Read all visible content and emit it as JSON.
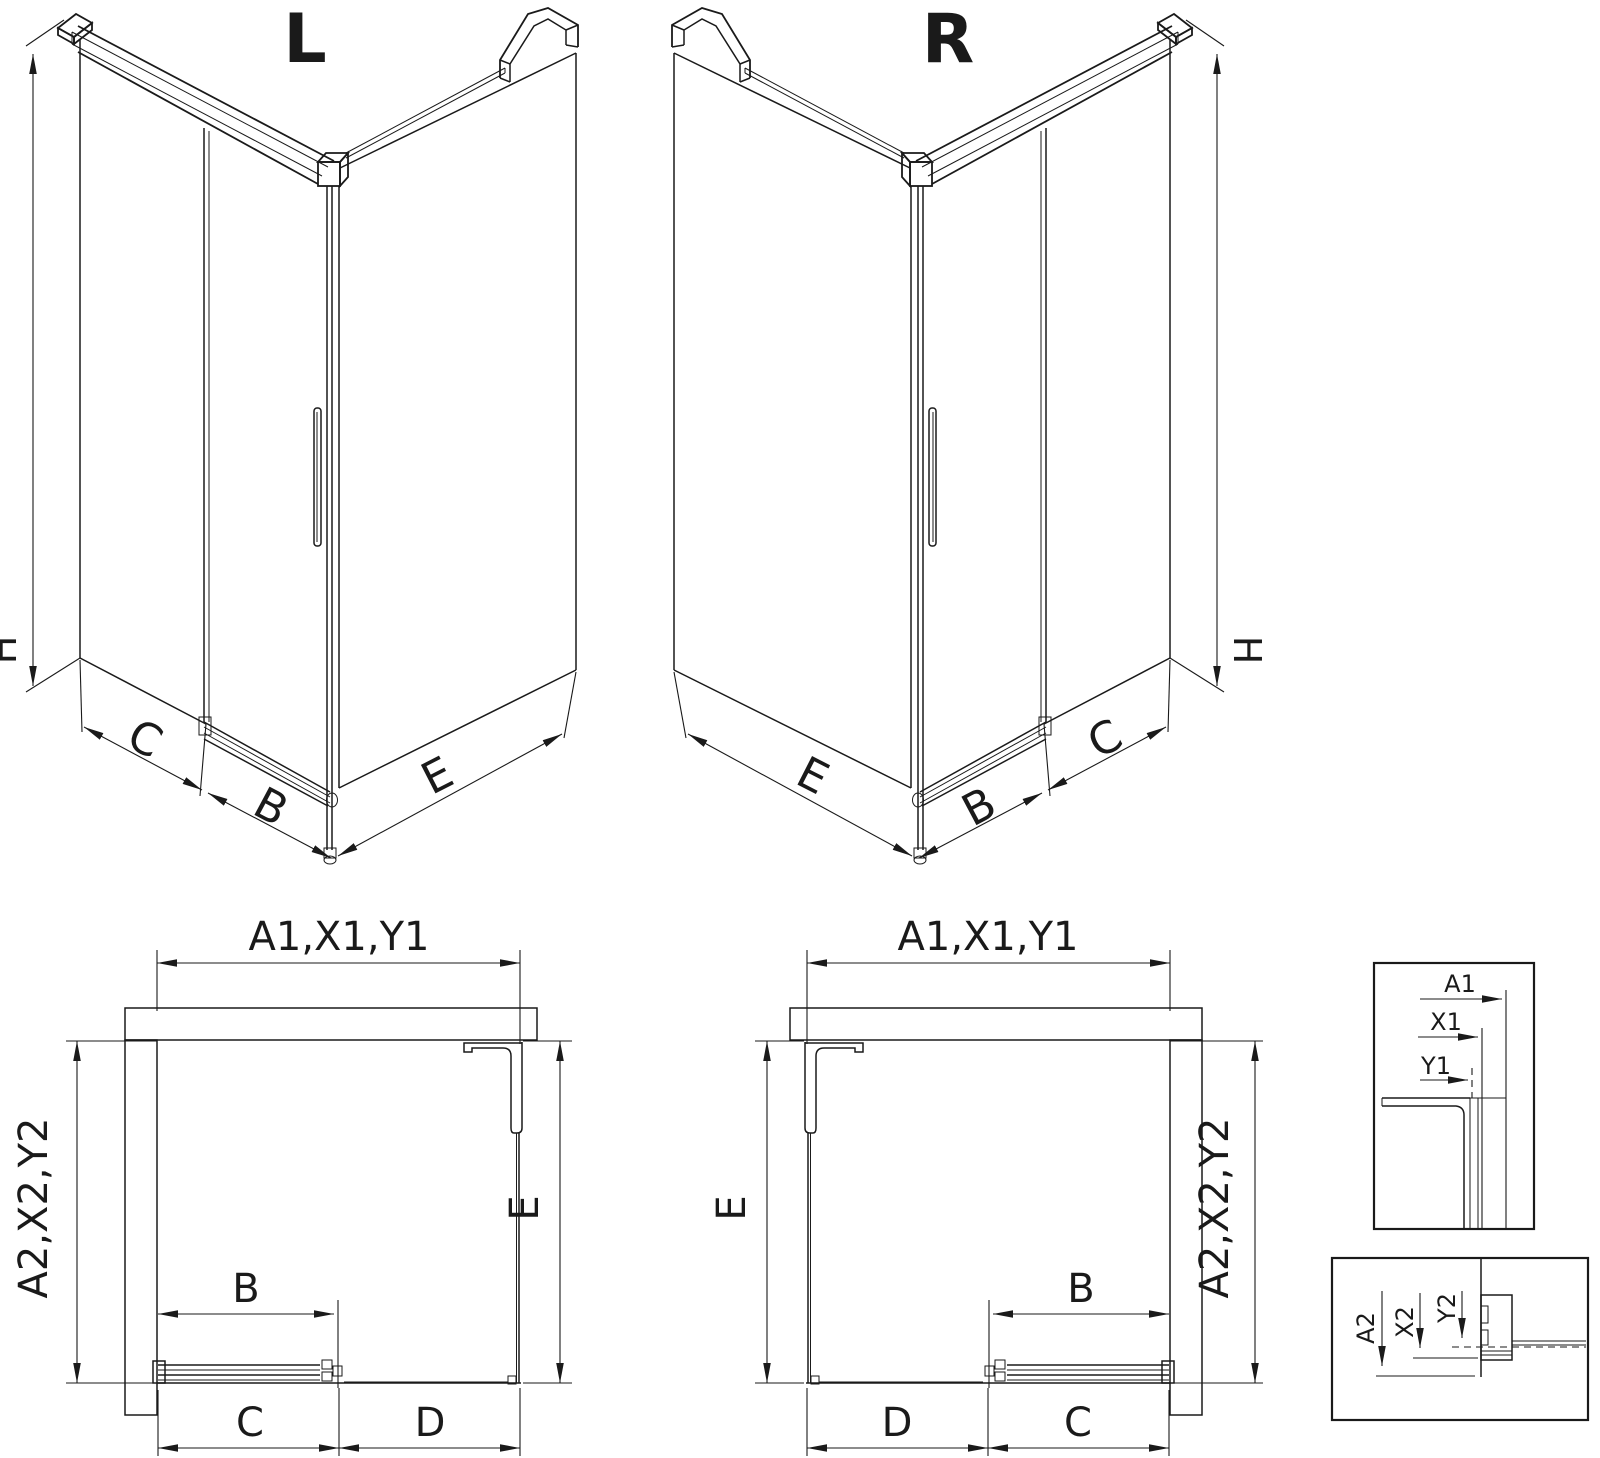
{
  "colors": {
    "line": "#1a1a1a",
    "background": "#ffffff"
  },
  "views": {
    "iso_left": {
      "title": "L",
      "dim_height": "H",
      "dim_c": "C",
      "dim_b": "B",
      "dim_e": "E"
    },
    "iso_right": {
      "title": "R",
      "dim_height": "H",
      "dim_c": "C",
      "dim_b": "B",
      "dim_e": "E"
    },
    "plan_left": {
      "dim_width": "A1,X1,Y1",
      "dim_depth": "A2,X2,Y2",
      "dim_b": "B",
      "dim_c": "C",
      "dim_d": "D",
      "dim_e": "E"
    },
    "plan_right": {
      "dim_width": "A1,X1,Y1",
      "dim_depth": "A2,X2,Y2",
      "dim_b": "B",
      "dim_c": "C",
      "dim_d": "D",
      "dim_e": "E"
    },
    "detail_width_refs": {
      "dim_a1": "A1",
      "dim_x1": "X1",
      "dim_y1": "Y1"
    },
    "detail_depth_refs": {
      "dim_a2": "A2",
      "dim_x2": "X2",
      "dim_y2": "Y2"
    }
  }
}
